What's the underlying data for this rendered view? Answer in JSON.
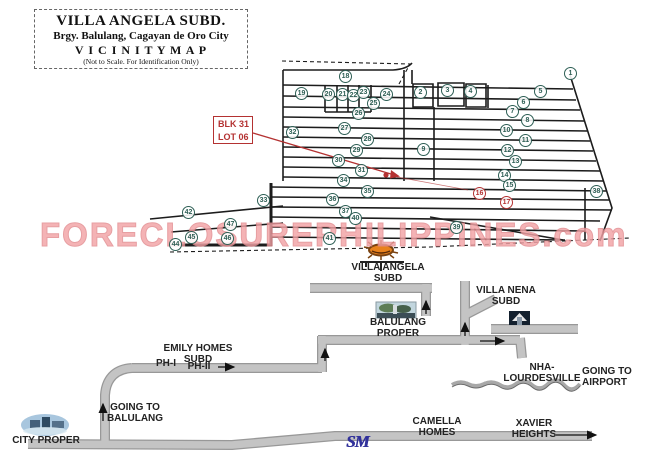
{
  "title_box": {
    "line1": "VILLA ANGELA SUBD.",
    "line2": "Brgy. Balulang, Cagayan de Oro City",
    "line3": "V I C I N I T Y   M A P",
    "line4": "(Not to Scale. For Identification Only)"
  },
  "watermark": "FORECLOSUREPHILIPPINES.com",
  "annotation": {
    "lot_label": "BLK 31\nLOT 06"
  },
  "labels": {
    "villa_angela": "VILLA ANGELA\nSUBD",
    "villa_nena": "VILLA NENA\nSUBD",
    "balulang_proper": "BALULANG\nPROPER",
    "emily_homes": "EMILY HOMES\nSUBD",
    "ph1": "PH-I",
    "ph2": "PH-II",
    "nha_lourdesville": "NHA-\nLOURDESVILLE",
    "going_to_airport": "GOING TO\nAIRPORT",
    "going_to_balulang": "GOING TO\nBALULANG",
    "city_proper": "CITY PROPER",
    "camella_homes": "CAMELLA\nHOMES",
    "xavier_heights": "XAVIER\nHEIGHTS",
    "sm_logo": "SM"
  },
  "map": {
    "lot_markers": [
      {
        "n": 1,
        "x": 571,
        "y": 74
      },
      {
        "n": 2,
        "x": 421,
        "y": 93
      },
      {
        "n": 3,
        "x": 448,
        "y": 91
      },
      {
        "n": 4,
        "x": 471,
        "y": 92
      },
      {
        "n": 5,
        "x": 541,
        "y": 92
      },
      {
        "n": 6,
        "x": 524,
        "y": 103
      },
      {
        "n": 7,
        "x": 513,
        "y": 112
      },
      {
        "n": 8,
        "x": 528,
        "y": 121
      },
      {
        "n": 9,
        "x": 424,
        "y": 150
      },
      {
        "n": 10,
        "x": 507,
        "y": 131
      },
      {
        "n": 11,
        "x": 526,
        "y": 141
      },
      {
        "n": 12,
        "x": 508,
        "y": 151
      },
      {
        "n": 13,
        "x": 516,
        "y": 162
      },
      {
        "n": 14,
        "x": 505,
        "y": 176
      },
      {
        "n": 15,
        "x": 510,
        "y": 186
      },
      {
        "n": 16,
        "x": 480,
        "y": 194,
        "red": true
      },
      {
        "n": 17,
        "x": 507,
        "y": 203,
        "red": true
      },
      {
        "n": 18,
        "x": 346,
        "y": 77
      },
      {
        "n": 19,
        "x": 302,
        "y": 94
      },
      {
        "n": 20,
        "x": 329,
        "y": 95
      },
      {
        "n": 21,
        "x": 343,
        "y": 95
      },
      {
        "n": 22,
        "x": 354,
        "y": 96
      },
      {
        "n": 23,
        "x": 364,
        "y": 93
      },
      {
        "n": 24,
        "x": 387,
        "y": 95
      },
      {
        "n": 25,
        "x": 374,
        "y": 104
      },
      {
        "n": 26,
        "x": 359,
        "y": 114
      },
      {
        "n": 27,
        "x": 345,
        "y": 129
      },
      {
        "n": 28,
        "x": 368,
        "y": 140
      },
      {
        "n": 29,
        "x": 357,
        "y": 151
      },
      {
        "n": 30,
        "x": 339,
        "y": 161
      },
      {
        "n": 31,
        "x": 362,
        "y": 171
      },
      {
        "n": 32,
        "x": 293,
        "y": 133
      },
      {
        "n": 33,
        "x": 264,
        "y": 201
      },
      {
        "n": 34,
        "x": 344,
        "y": 181
      },
      {
        "n": 35,
        "x": 368,
        "y": 192
      },
      {
        "n": 36,
        "x": 333,
        "y": 200
      },
      {
        "n": 37,
        "x": 346,
        "y": 212
      },
      {
        "n": 38,
        "x": 597,
        "y": 192
      },
      {
        "n": 39,
        "x": 457,
        "y": 228
      },
      {
        "n": 40,
        "x": 356,
        "y": 219
      },
      {
        "n": 41,
        "x": 330,
        "y": 239
      },
      {
        "n": 42,
        "x": 189,
        "y": 213
      },
      {
        "n": 44,
        "x": 176,
        "y": 245
      },
      {
        "n": 45,
        "x": 192,
        "y": 238
      },
      {
        "n": 46,
        "x": 228,
        "y": 239
      },
      {
        "n": 47,
        "x": 231,
        "y": 225
      }
    ]
  },
  "colors": {
    "ink": "#1c1c1c",
    "red": "#b43232",
    "road-fill": "#c4c4c4",
    "road-edge": "#989898",
    "watermark": "#f2a3a6",
    "marker": "#2e5f55",
    "sm-blue": "#31319b",
    "sun-orange": "#e8821e"
  }
}
